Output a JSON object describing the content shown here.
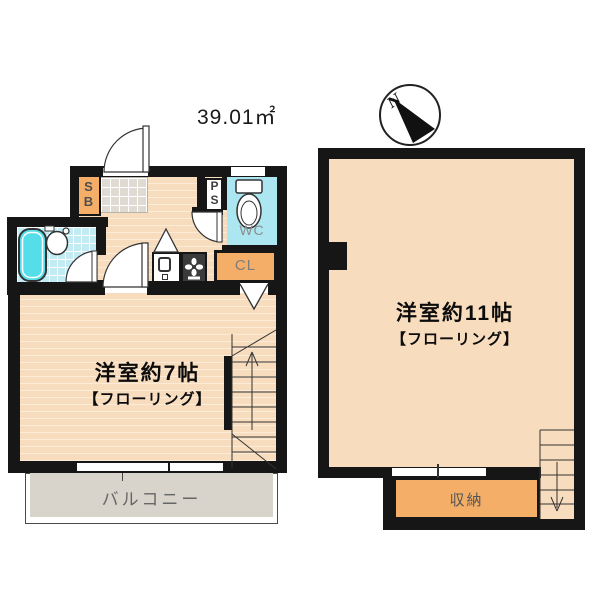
{
  "header": {
    "area_label": "39.01㎡",
    "compass_n": "N"
  },
  "floor1": {
    "room_name": "洋室約7帖",
    "room_floor_type": "【フローリング】",
    "balcony_label": "バルコニー",
    "shoebox_label": "SB",
    "pipe_space_label": "PS",
    "toilet_label": "WC",
    "closet_label": "CL"
  },
  "floor2": {
    "room_name": "洋室約11帖",
    "room_floor_type": "【フローリング】",
    "storage_label": "収納"
  },
  "colors": {
    "wall": "#161616",
    "floor_peach": "#F8DCBE",
    "accent_orange": "#F4AE68",
    "water_cyan": "#ACE6F1",
    "bathtub_cyan": "#55DEE9",
    "balcony_gray": "#D8D4CB"
  }
}
